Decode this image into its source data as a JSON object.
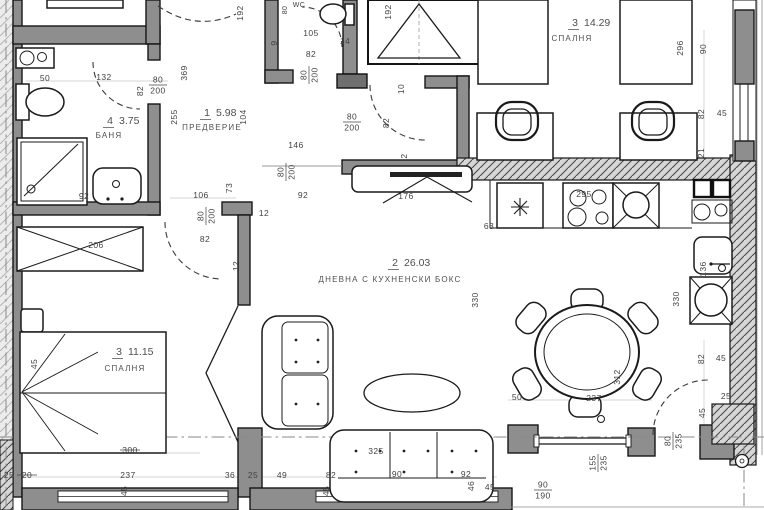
{
  "title": "Apartment floor plan",
  "colors": {
    "wall": "#8e8e8e",
    "outline": "#161616",
    "dim_text": "#424242",
    "hatch_bg": "#d6d6d6"
  },
  "rooms": [
    {
      "num": "4",
      "area": "3.75",
      "name": "БАНЯ",
      "x": 113,
      "y": 124,
      "nx": 109,
      "ny": 138
    },
    {
      "num": "1",
      "area": "5.98",
      "name": "ПРЕДВЕРИЕ",
      "x": 210,
      "y": 116,
      "nx": 212,
      "ny": 130
    },
    {
      "num": "3",
      "area": "14.29",
      "name": "СПАЛНЯ",
      "x": 578,
      "y": 26,
      "nx": 572,
      "ny": 41
    },
    {
      "num": "2",
      "area": "26.03",
      "name": "ДНЕВНА С КУХНЕНСКИ БОКС",
      "x": 398,
      "y": 266,
      "nx": 390,
      "ny": 282
    },
    {
      "num": "3",
      "area": "11.15",
      "name": "СПАЛНЯ",
      "x": 122,
      "y": 355,
      "nx": 125,
      "ny": 371
    }
  ],
  "dims": [
    {
      "t": "50",
      "x": 45,
      "y": 81
    },
    {
      "t": "132",
      "x": 104,
      "y": 80
    },
    {
      "t": "82",
      "x": 143,
      "y": 91,
      "r": 1
    },
    {
      "t": "80",
      "t2": "200",
      "x": 158,
      "y": 85
    },
    {
      "t": "369",
      "x": 187,
      "y": 73,
      "r": 1
    },
    {
      "t": "192",
      "x": 243,
      "y": 13,
      "r": 1
    },
    {
      "t": "255",
      "x": 177,
      "y": 117,
      "r": 1
    },
    {
      "t": "104",
      "x": 246,
      "y": 117,
      "r": 1
    },
    {
      "t": "WC",
      "x": 299,
      "y": 7,
      "s": 7
    },
    {
      "t": "80",
      "x": 287,
      "y": 10,
      "r": 1,
      "s": 7
    },
    {
      "t": "105",
      "x": 311,
      "y": 36
    },
    {
      "t": "82",
      "x": 311,
      "y": 57
    },
    {
      "t": "80",
      "t2": "200",
      "x": 309,
      "y": 75,
      "r": 1
    },
    {
      "t": "14",
      "x": 345,
      "y": 44
    },
    {
      "t": "9",
      "x": 277,
      "y": 43,
      "r": 1
    },
    {
      "t": "192",
      "x": 391,
      "y": 12,
      "r": 1
    },
    {
      "t": "10",
      "x": 404,
      "y": 89,
      "r": 1
    },
    {
      "t": "80",
      "t2": "200",
      "x": 352,
      "y": 122
    },
    {
      "t": "82",
      "x": 389,
      "y": 123,
      "r": 1
    },
    {
      "t": "2",
      "x": 407,
      "y": 156,
      "r": 1
    },
    {
      "t": "146",
      "x": 296,
      "y": 148
    },
    {
      "t": "80",
      "t2": "200",
      "x": 286,
      "y": 172,
      "r": 1
    },
    {
      "t": "92",
      "x": 303,
      "y": 198
    },
    {
      "t": "296",
      "x": 683,
      "y": 48,
      "r": 1
    },
    {
      "t": "90",
      "x": 706,
      "y": 49,
      "r": 1
    },
    {
      "t": "82",
      "x": 704,
      "y": 114,
      "r": 1
    },
    {
      "t": "45",
      "x": 722,
      "y": 116
    },
    {
      "t": "21",
      "x": 704,
      "y": 153,
      "r": 1
    },
    {
      "t": "73",
      "x": 232,
      "y": 188,
      "r": 1
    },
    {
      "t": "106",
      "x": 201,
      "y": 198
    },
    {
      "t": "80",
      "t2": "200",
      "x": 206,
      "y": 216,
      "r": 1
    },
    {
      "t": "82",
      "x": 205,
      "y": 242
    },
    {
      "t": "12",
      "x": 239,
      "y": 266,
      "r": 1
    },
    {
      "t": "12",
      "x": 264,
      "y": 216
    },
    {
      "t": "206",
      "x": 96,
      "y": 248
    },
    {
      "t": "92",
      "x": 84,
      "y": 199
    },
    {
      "t": "176",
      "x": 406,
      "y": 199
    },
    {
      "t": "295",
      "x": 584,
      "y": 197
    },
    {
      "t": "63",
      "x": 489,
      "y": 229
    },
    {
      "t": "330",
      "x": 478,
      "y": 300,
      "r": 1
    },
    {
      "t": "330",
      "x": 679,
      "y": 299,
      "r": 1
    },
    {
      "t": "136",
      "x": 706,
      "y": 269,
      "r": 1
    },
    {
      "t": "45",
      "x": 37,
      "y": 364,
      "r": 1
    },
    {
      "t": "300",
      "x": 130,
      "y": 453,
      "strike": 1
    },
    {
      "t": "25",
      "x": 9,
      "y": 478
    },
    {
      "t": "20",
      "x": 27,
      "y": 478,
      "strike": 1
    },
    {
      "t": "237",
      "x": 128,
      "y": 478
    },
    {
      "t": "36",
      "x": 230,
      "y": 478
    },
    {
      "t": "25",
      "x": 253,
      "y": 478
    },
    {
      "t": "45",
      "x": 127,
      "y": 491,
      "r": 1
    },
    {
      "t": "49",
      "x": 282,
      "y": 478
    },
    {
      "t": "82",
      "x": 331,
      "y": 478
    },
    {
      "t": "325",
      "x": 376,
      "y": 454
    },
    {
      "t": "90",
      "x": 397,
      "y": 477
    },
    {
      "t": "92",
      "x": 466,
      "y": 477
    },
    {
      "t": "45",
      "x": 329,
      "y": 491,
      "r": 1
    },
    {
      "t": "46",
      "x": 474,
      "y": 486,
      "r": 1
    },
    {
      "t": "45",
      "x": 490,
      "y": 490
    },
    {
      "t": "50",
      "x": 517,
      "y": 400
    },
    {
      "t": "237",
      "x": 594,
      "y": 401
    },
    {
      "t": "312",
      "x": 620,
      "y": 377,
      "r": 1
    },
    {
      "t": "82",
      "x": 704,
      "y": 359,
      "r": 1
    },
    {
      "t": "45",
      "x": 721,
      "y": 361
    },
    {
      "t": "25",
      "x": 726,
      "y": 399
    },
    {
      "t": "45",
      "x": 705,
      "y": 413,
      "r": 1
    },
    {
      "t": "80",
      "t2": "235",
      "x": 673,
      "y": 441,
      "r": 1
    },
    {
      "t": "155",
      "t2": "235",
      "x": 598,
      "y": 463,
      "r": 1
    },
    {
      "t": "90",
      "t2": "190",
      "x": 543,
      "y": 490
    }
  ]
}
